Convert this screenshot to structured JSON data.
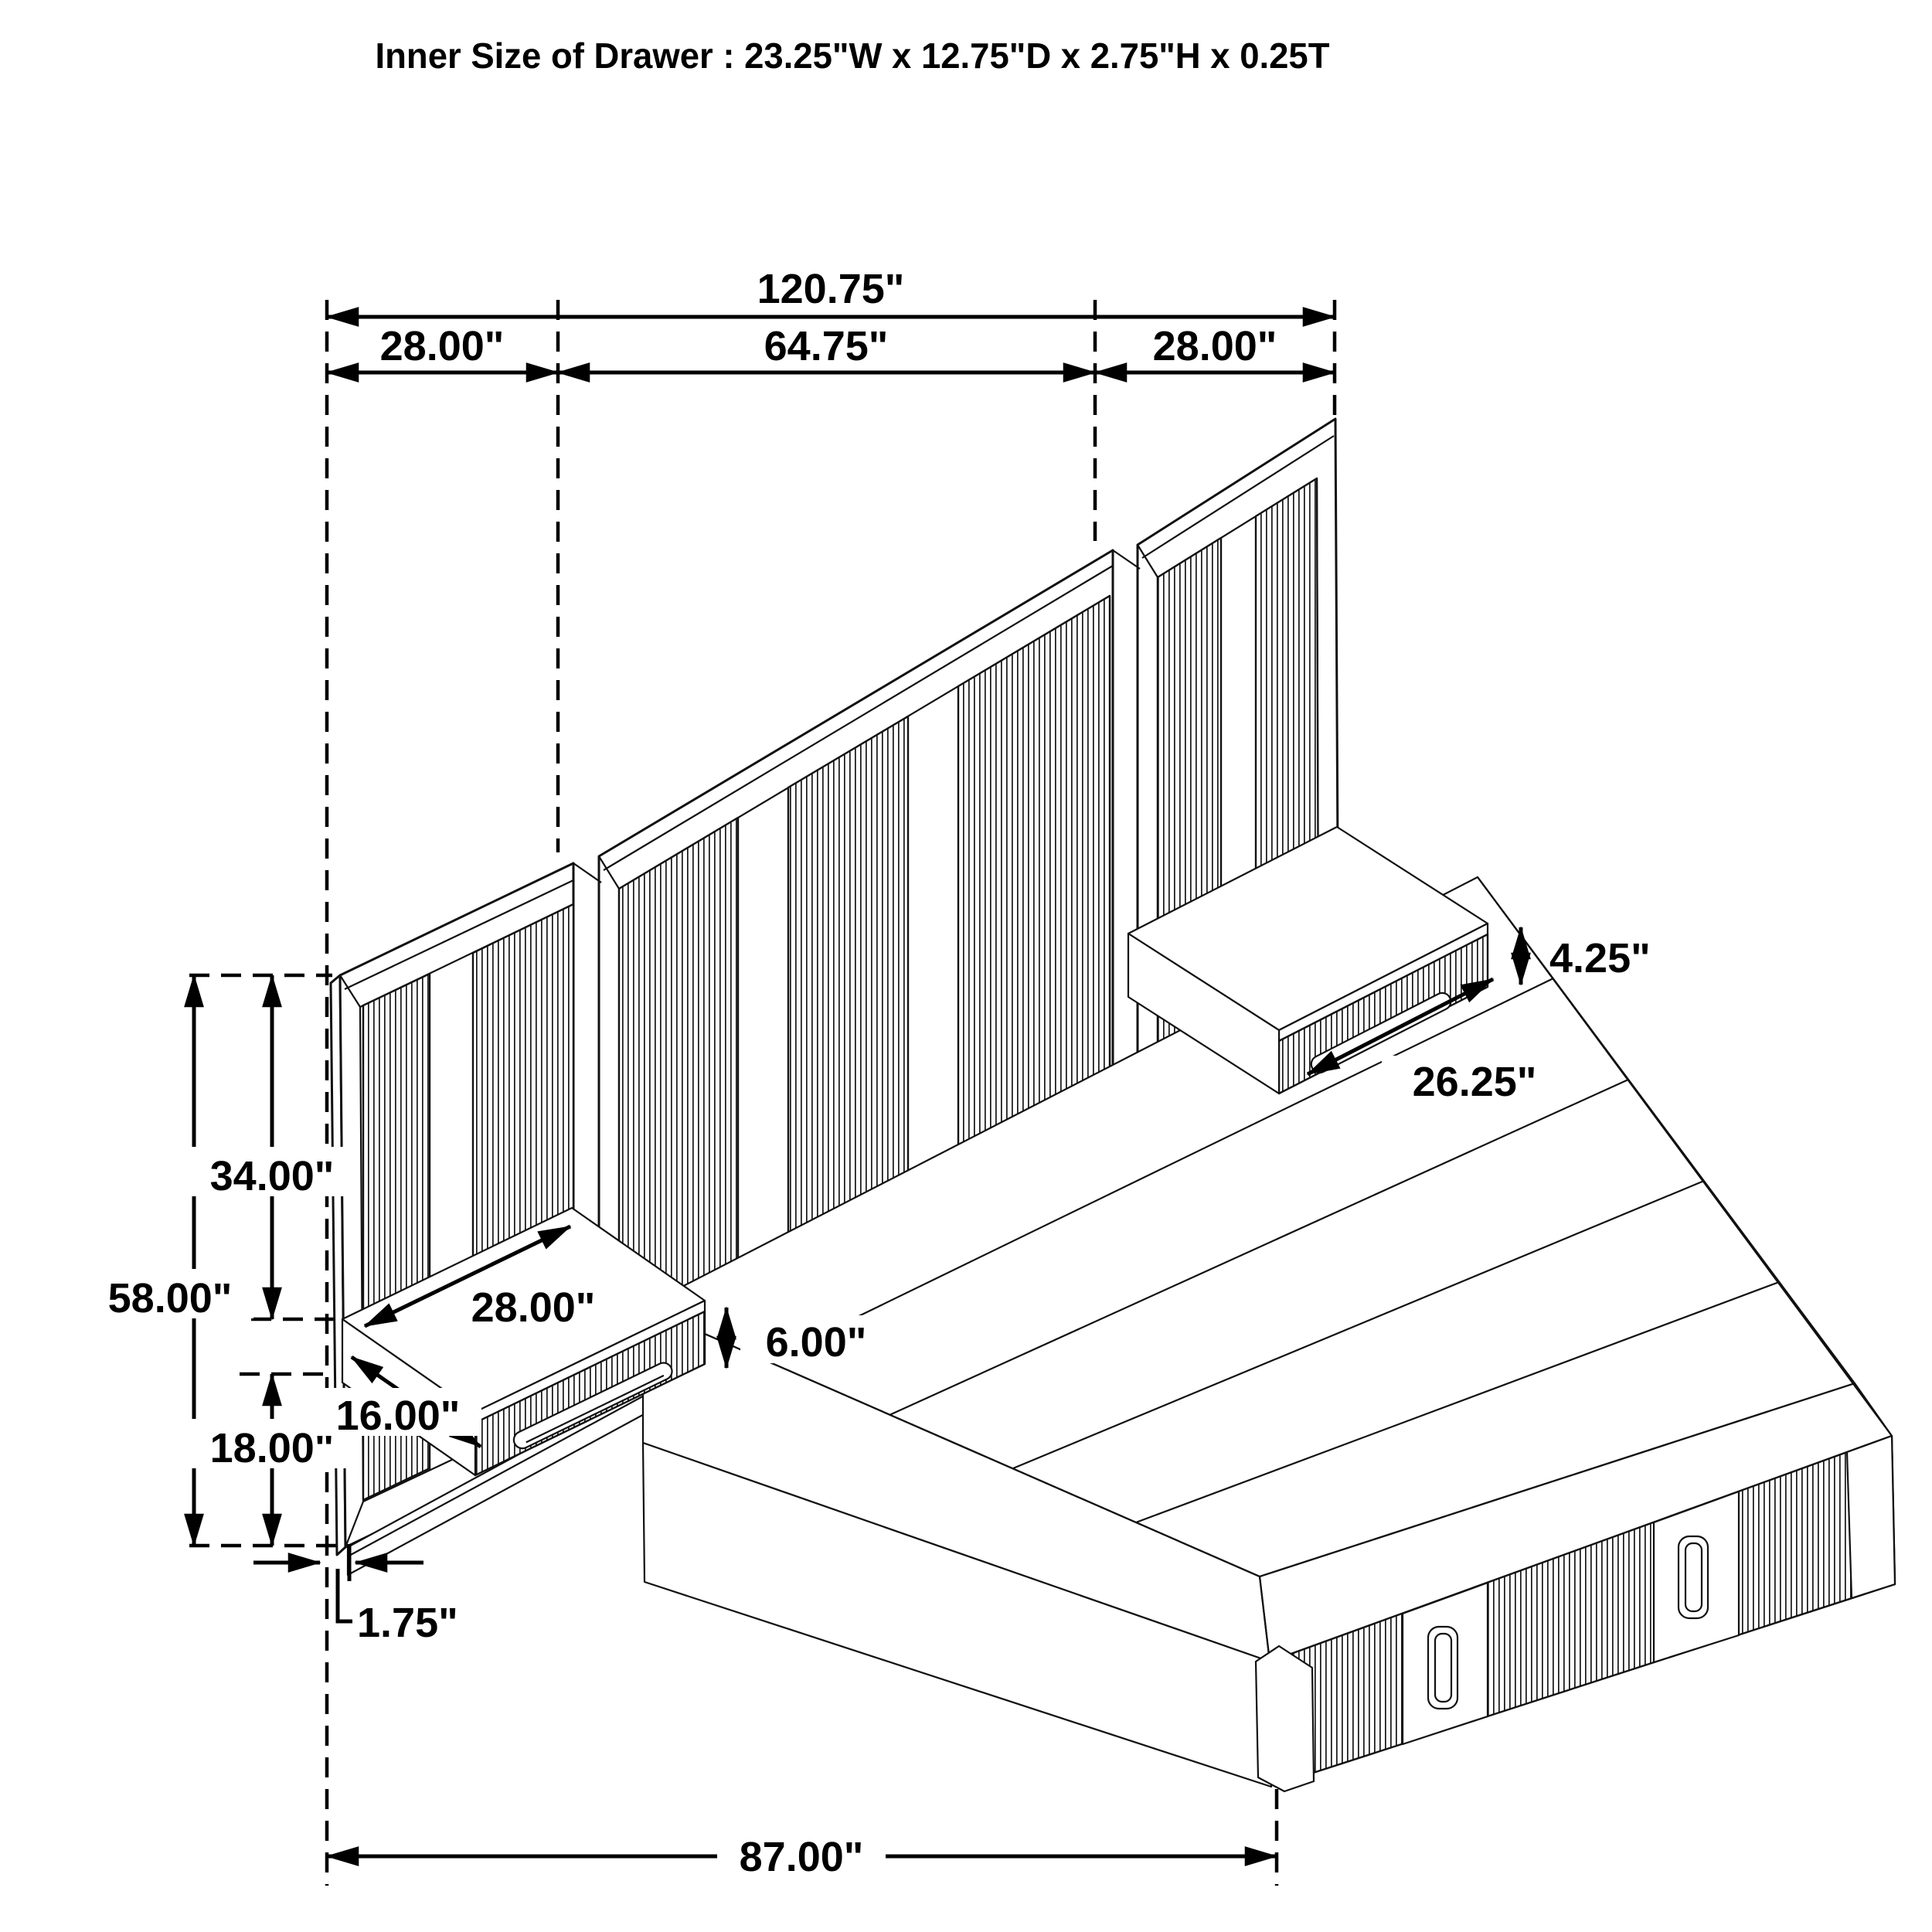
{
  "title": "Inner Size of Drawer : 23.25\"W x 12.75\"D x 2.75\"H x 0.25T",
  "drawing": {
    "type": "isometric dimension diagram",
    "subject": "wall-panel platform bed with floating nightstands and storage drawers",
    "line_color": "#000000",
    "background_color": "#ffffff"
  },
  "dimensions": {
    "overall_width": "120.75\"",
    "left_panel_width": "28.00\"",
    "center_panel_width": "64.75\"",
    "right_panel_width": "28.00\"",
    "right_nightstand_height": "4.25\"",
    "right_nightstand_width": "26.25\"",
    "panel_above_nightstand_height": "34.00\"",
    "panel_total_height": "58.00\"",
    "left_nightstand_width": "28.00\"",
    "left_nightstand_height": "6.00\"",
    "left_nightstand_depth": "16.00\"",
    "panel_below_nightstand_height": "18.00\"",
    "panel_thickness": "1.75\"",
    "bed_length": "87.00\""
  }
}
